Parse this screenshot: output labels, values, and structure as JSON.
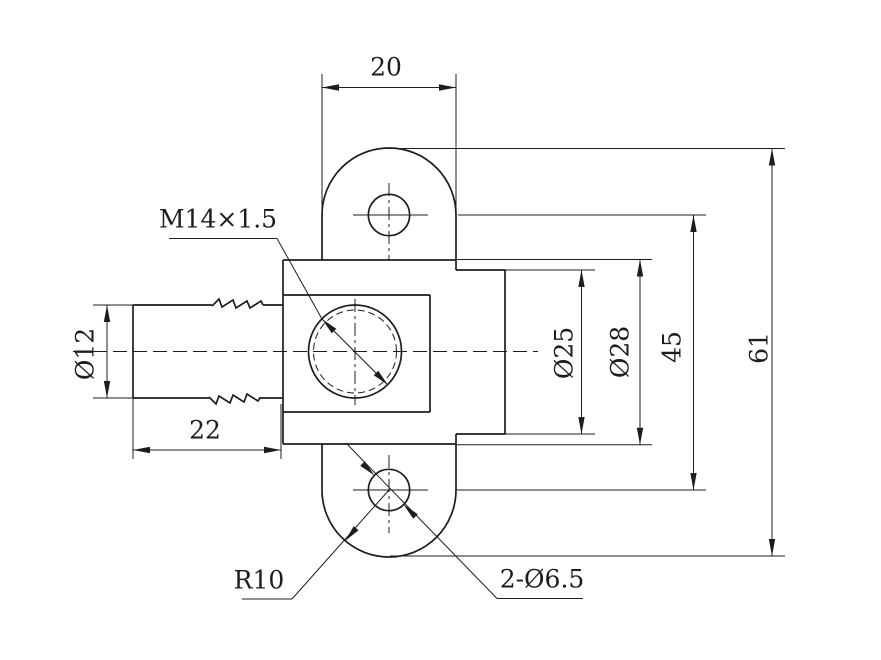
{
  "labels": {
    "lug_width": "20",
    "thread": "M14×1.5",
    "barb_dia": "Ø12",
    "barb_len": "22",
    "bore_dia": "Ø25",
    "flange_dia": "Ø28",
    "hole_spacing": "45",
    "overall_height": "61",
    "lug_radius": "R10",
    "mount_holes": "2-Ø6.5"
  },
  "geometry": {
    "canvas": {
      "w": 881,
      "h": 660
    },
    "ink": "#1d1d1d",
    "outline_width": 1.7,
    "thin_width": 1,
    "outline_lines": [
      [
        133,
        305,
        212,
        305
      ],
      [
        263,
        305,
        283,
        305
      ],
      [
        133,
        398,
        209,
        398
      ],
      [
        259,
        398,
        283,
        398
      ],
      [
        133,
        305,
        133,
        398
      ],
      [
        283,
        260,
        455,
        260
      ],
      [
        283,
        444,
        455,
        444
      ],
      [
        283,
        260,
        283,
        444
      ],
      [
        283,
        295,
        430,
        295
      ],
      [
        430,
        295,
        430,
        412
      ],
      [
        283,
        412,
        430,
        412
      ],
      [
        456,
        270,
        505,
        270
      ],
      [
        456,
        434,
        505,
        434
      ],
      [
        505,
        270,
        505,
        434
      ],
      [
        322,
        215,
        322,
        260
      ],
      [
        456,
        215,
        456,
        270
      ],
      [
        322,
        444,
        322,
        490
      ],
      [
        456,
        434,
        456,
        490
      ]
    ],
    "zigzags": [
      [
        [
          212,
          306
        ],
        [
          219,
          299
        ],
        [
          222,
          307
        ],
        [
          233,
          300
        ],
        [
          236,
          308
        ],
        [
          247,
          301
        ],
        [
          250,
          308
        ],
        [
          261,
          301
        ],
        [
          263,
          305
        ]
      ],
      [
        [
          209,
          397
        ],
        [
          216,
          404
        ],
        [
          219,
          396
        ],
        [
          230,
          403
        ],
        [
          233,
          395
        ],
        [
          244,
          402
        ],
        [
          247,
          394
        ],
        [
          258,
          401
        ],
        [
          260,
          398
        ]
      ]
    ],
    "arcs": [
      "M 322 215 A 67 67 0 0 1 456 215",
      "M 322 490 A 67 67 0 0 0 456 490"
    ],
    "solid_circles": [
      [
        389,
        215,
        20.7
      ],
      [
        389,
        490,
        20.7
      ],
      [
        355,
        351.5,
        46.5
      ]
    ],
    "dashed_circles": [
      [
        355,
        351.5,
        41.5
      ]
    ],
    "thin_lines": [
      [
        322,
        74,
        322,
        215
      ],
      [
        456,
        74,
        456,
        215
      ],
      [
        322,
        87.5,
        456,
        87.5
      ],
      [
        93,
        305,
        133,
        305
      ],
      [
        93,
        398,
        133,
        398
      ],
      [
        107,
        305,
        107,
        398
      ],
      [
        133,
        398,
        133,
        459
      ],
      [
        281,
        404,
        281,
        459
      ],
      [
        133,
        450,
        281,
        450
      ],
      [
        505,
        270,
        595,
        270
      ],
      [
        505,
        434,
        595,
        434
      ],
      [
        581.5,
        270,
        581.5,
        434
      ],
      [
        455,
        259.5,
        652,
        259.5
      ],
      [
        455,
        444.7,
        652,
        444.7
      ],
      [
        640,
        259.5,
        640,
        444.7
      ],
      [
        353,
        215,
        428,
        215
      ],
      [
        458,
        215,
        706,
        215
      ],
      [
        353,
        490,
        428,
        490
      ],
      [
        457,
        490,
        706,
        490
      ],
      [
        693.5,
        215,
        693.5,
        490
      ],
      [
        389,
        148.5,
        785,
        148.5
      ],
      [
        390,
        556,
        785,
        556
      ],
      [
        772,
        148.5,
        772,
        556
      ],
      [
        169,
        238.5,
        277,
        238.5
      ],
      [
        277,
        238.5,
        322,
        319
      ],
      [
        322,
        319,
        388,
        385
      ],
      [
        242,
        599,
        292,
        599
      ],
      [
        292,
        599,
        389,
        490
      ],
      [
        497,
        598.5,
        583,
        598.5
      ],
      [
        346,
        443,
        497,
        598.5
      ]
    ],
    "center_lines": [
      [
        355,
        299,
        355,
        405
      ],
      [
        389,
        183,
        389,
        260
      ],
      [
        389,
        455,
        389,
        533
      ]
    ],
    "axis_lines": [
      [
        73,
        351.5,
        538,
        351.5
      ]
    ],
    "arrowheads": [
      [
        322,
        87.5,
        180
      ],
      [
        456,
        87.5,
        0
      ],
      [
        107,
        305,
        270
      ],
      [
        107,
        398,
        90
      ],
      [
        133,
        450,
        180
      ],
      [
        281,
        450,
        0
      ],
      [
        581.5,
        270,
        270
      ],
      [
        581.5,
        434,
        90
      ],
      [
        640,
        259.5,
        270
      ],
      [
        640,
        444.7,
        90
      ],
      [
        693.5,
        215,
        270
      ],
      [
        693.5,
        490,
        90
      ],
      [
        772,
        148.5,
        270
      ],
      [
        772,
        556,
        90
      ],
      [
        322,
        319,
        225
      ],
      [
        388,
        385,
        45
      ],
      [
        345,
        541,
        131
      ],
      [
        374.5,
        475.5,
        45
      ],
      [
        403.5,
        504.5,
        225
      ]
    ]
  }
}
